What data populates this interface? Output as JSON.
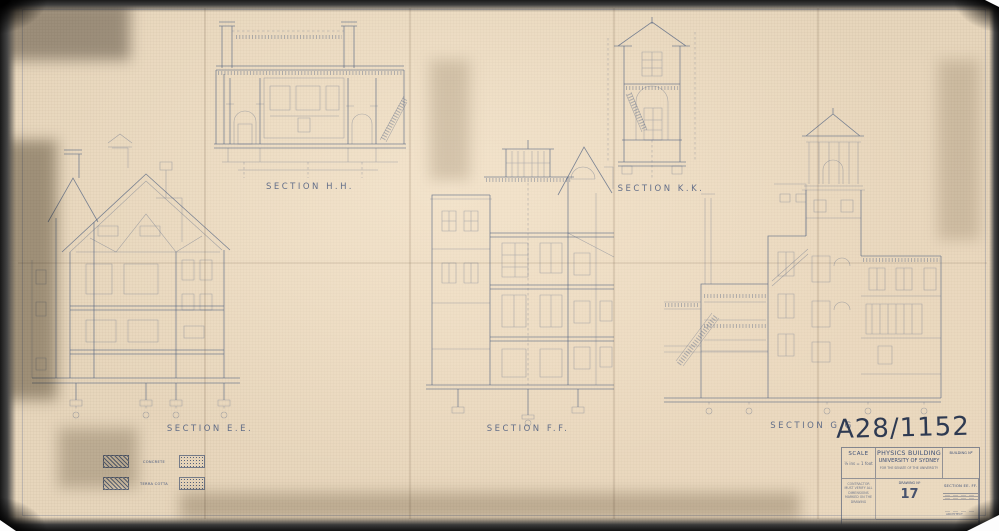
{
  "document": {
    "archive_number": "A28/1152",
    "sections": [
      {
        "id": "hh",
        "label": "SECTION H.H."
      },
      {
        "id": "kk",
        "label": "SECTION K.K."
      },
      {
        "id": "ee",
        "label": "SECTION E.E."
      },
      {
        "id": "ff",
        "label": "SECTION F.F."
      },
      {
        "id": "gg",
        "label": "SECTION G.G"
      }
    ],
    "legend": {
      "items": [
        {
          "label": "CONCRETE"
        },
        {
          "label": "TERRA COTTA"
        }
      ]
    },
    "title_block": {
      "scale_label": "SCALE",
      "scale_value": "⅛ ins = 1 foot",
      "project_name_line1": "PHYSICS BUILDING",
      "project_name_line2": "UNIVERSITY OF SYDNEY",
      "project_name_line3": "FOR THE SENATE OF THE UNIVERSITY",
      "building_no_label": "BUILDING Nº",
      "contractor_note": "CONTRACTOR MUST VERIFY ALL DIMENSIONS MARKED ON THE DRAWING",
      "sheet_title": "SECTION EE. FF. GG. (HH. KK)",
      "drawing_no_label": "DRAWING Nº",
      "drawing_number": "17",
      "architect_label": "ARCHITECT"
    },
    "colors": {
      "ink": "#4d5f80",
      "paper": "#e7d6bc",
      "handwriting": "#1f2d49"
    }
  }
}
